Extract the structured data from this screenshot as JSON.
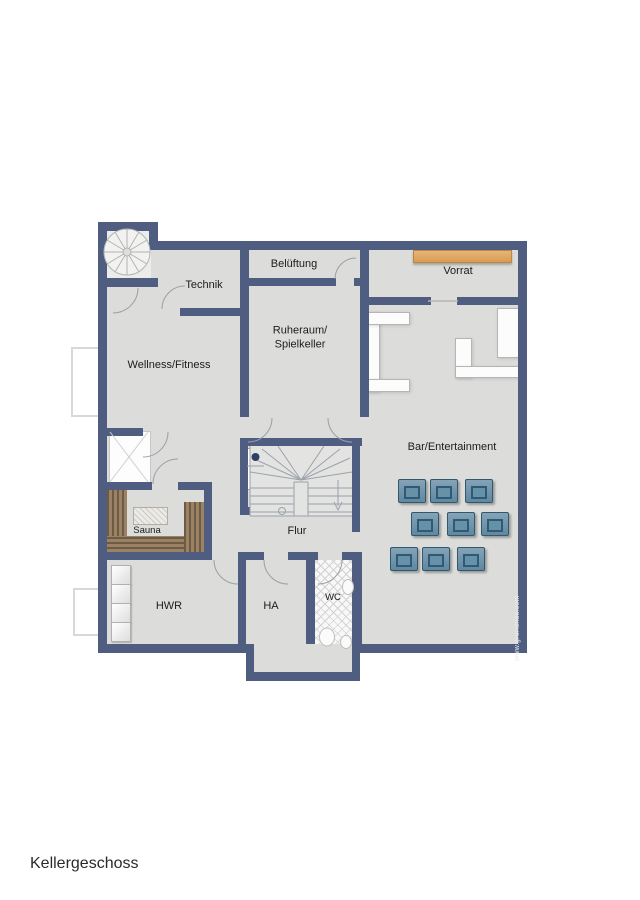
{
  "plan": {
    "floor_label": "Kellergeschoss",
    "watermark": "www.grundriss.com",
    "rooms": {
      "technik": {
        "label": "Technik"
      },
      "belueftung": {
        "label": "Belüftung"
      },
      "vorrat": {
        "label": "Vorrat"
      },
      "wellness": {
        "label": "Wellness/Fitness"
      },
      "ruheraum": {
        "label": "Ruheraum/\nSpielkeller"
      },
      "bar": {
        "label": "Bar/Entertainment"
      },
      "sauna": {
        "label": "Sauna"
      },
      "flur": {
        "label": "Flur"
      },
      "hwr": {
        "label": "HWR"
      },
      "ha": {
        "label": "HA"
      },
      "wc": {
        "label": "WC"
      }
    },
    "colors": {
      "wall": "#4e5d80",
      "floor": "#dcdcda",
      "wood_bench": "#8a7157",
      "storage_shelf": "#e0a868",
      "armchair": "#6e93ab"
    },
    "furniture_counts": {
      "armchairs": 9,
      "hwr_appliances": 4
    }
  }
}
